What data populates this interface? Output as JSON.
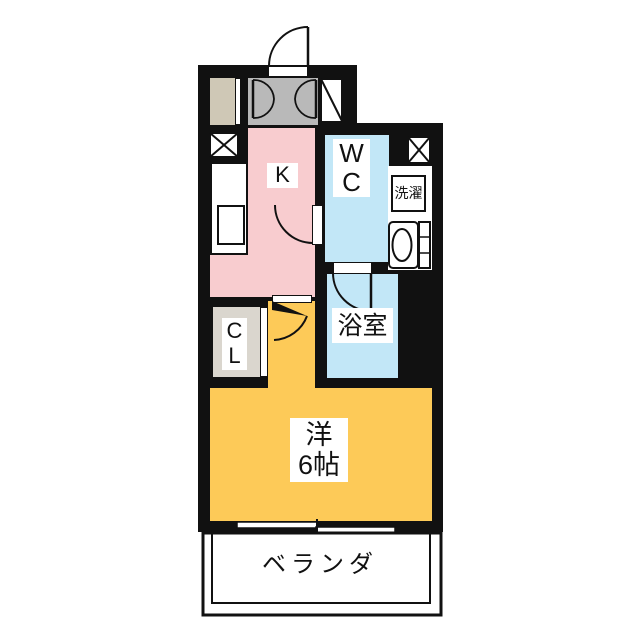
{
  "floorplan": {
    "rooms": {
      "kitchen": {
        "label": "K"
      },
      "toilet_room": {
        "line1": "W",
        "line2": "C"
      },
      "laundry": {
        "label": "洗濯"
      },
      "bathroom": {
        "label": "浴室"
      },
      "closet": {
        "line1": "C",
        "line2": "L"
      },
      "western_room": {
        "line1": "洋",
        "line2": "6帖"
      },
      "balcony": {
        "label": "ベランダ"
      }
    },
    "colors": {
      "wall": "#111111",
      "kitchen_floor": "#f8cccf",
      "wet_area_floor": "#c2e7f7",
      "western_room_floor": "#fdca58",
      "entrance_floor": "#b9b9b9",
      "shoe_cabinet": "#cfc8b6",
      "closet_floor": "#dad6ce",
      "background": "#ffffff"
    }
  }
}
